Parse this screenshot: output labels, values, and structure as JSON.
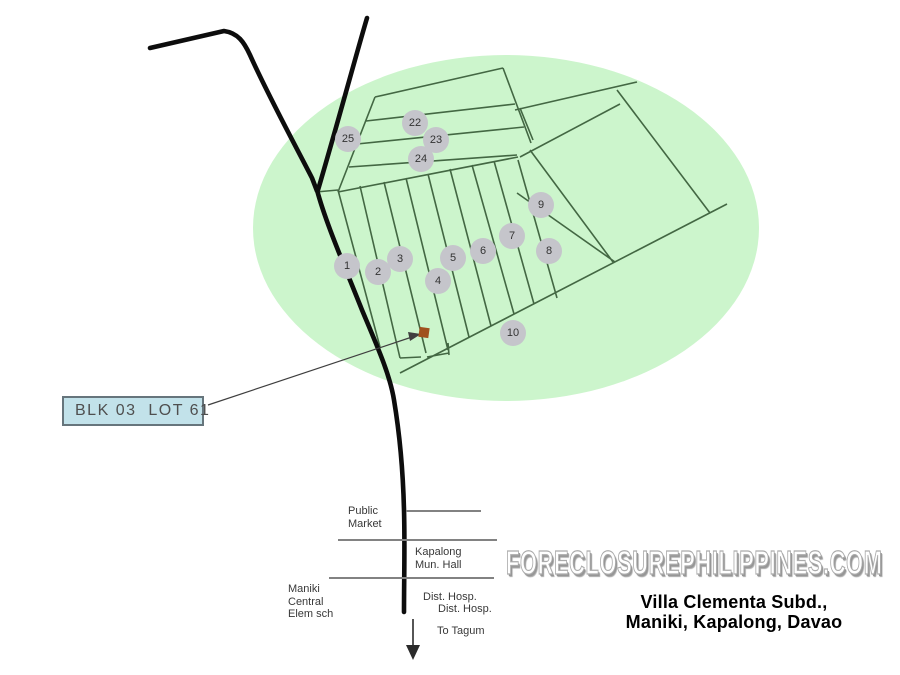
{
  "map": {
    "title_caption": "Villa Clementa Subd.,\nManiki, Kapalong, Davao",
    "watermark": "FORECLOSUREPHILIPPINES.COM",
    "callout": {
      "label": "BLK 03  LOT 61"
    },
    "markers": [
      {
        "label": "25",
        "x": 348,
        "y": 139
      },
      {
        "label": "22",
        "x": 415,
        "y": 123
      },
      {
        "label": "23",
        "x": 436,
        "y": 140
      },
      {
        "label": "24",
        "x": 421,
        "y": 159
      },
      {
        "label": "1",
        "x": 347,
        "y": 266
      },
      {
        "label": "2",
        "x": 378,
        "y": 272
      },
      {
        "label": "3",
        "x": 400,
        "y": 259
      },
      {
        "label": "4",
        "x": 438,
        "y": 281
      },
      {
        "label": "5",
        "x": 453,
        "y": 258
      },
      {
        "label": "6",
        "x": 483,
        "y": 251
      },
      {
        "label": "7",
        "x": 512,
        "y": 236
      },
      {
        "label": "8",
        "x": 549,
        "y": 251
      },
      {
        "label": "9",
        "x": 541,
        "y": 205
      },
      {
        "label": "10",
        "x": 513,
        "y": 333
      }
    ],
    "landmarks": {
      "public_market": "Public\nMarket",
      "municipal_hall": "Kapalong\nMun. Hall",
      "elem_school": "Maniki\nCentral\nElem sch",
      "district_hospital_1": "Dist. Hosp.",
      "district_hospital_2": "Dist. Hosp.",
      "to_tagum": "To Tagum"
    }
  },
  "colors": {
    "map_area": "#ccf5cc",
    "grid_line": "#436743",
    "road": "#0d0d0d",
    "street": "#828282",
    "marker_fill": "#c5c5cb",
    "marker_text": "#333333",
    "lot_square": "#a0511e",
    "callout_fill": "#c2e2ea",
    "callout_border": "#66757c",
    "callout_text": "#4f4f4f",
    "label_text": "#383838",
    "watermark_color": "#ffffff",
    "watermark_shadow": "#969696",
    "caption_color": "#000000"
  }
}
